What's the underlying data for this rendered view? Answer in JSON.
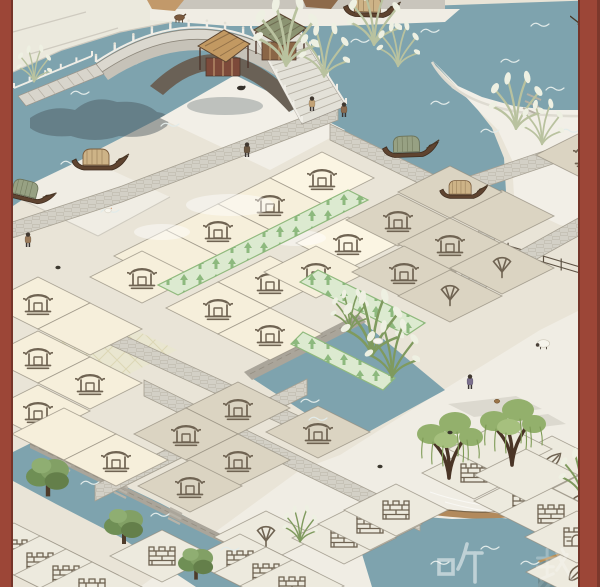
{
  "scene": {
    "title": "jiangnan-canal-town-map",
    "width": 600,
    "height": 587,
    "frame": {
      "color": "#9c4637",
      "left_width": 13,
      "right_width": 22
    }
  },
  "colors": {
    "frame": "#9c4637",
    "water": "#7ea3ae",
    "land": "#e9e4d7",
    "snow": "#f0ede4",
    "platform": "#f2efe7",
    "ledge": "#c9c5bc",
    "tile_cream": "#f6efdb",
    "tile_cream_light": "#fbf5e3",
    "tile_taupe": "#dbd4c2",
    "tile_pale": "#edeade",
    "tile_line": "#948d7f",
    "road": "#d3d0c6",
    "road_line": "#a59f91",
    "green_fill": "#dcead0",
    "green_border": "#8fb97c",
    "green_arrow": "#84b476",
    "icon_ink": "#6f6352",
    "bridge_stone": "#dbd8cf",
    "bridge_under": "#c6c2b8",
    "arch_dark": "#6a6156",
    "wall_stone": "#aaa59a",
    "pond_sand": "#b28a5c",
    "willow_green": "#93b06c",
    "reed_pale": "#b9c29f",
    "reed_dark": "#7f9a5e",
    "tree_green": "#6f8f55",
    "mat_teal": "#7e9ba1",
    "hull_brown": "#5f4430",
    "cabin_tan": "#cdb387",
    "cabin_green": "#97a183",
    "ink_shadow": "#46555c"
  },
  "watermarks": [
    {
      "char": "听",
      "glyph": "ting",
      "x": 436,
      "y": 538,
      "size": 48,
      "opacity": 0.5
    },
    {
      "char": "载",
      "glyph": "zai",
      "x": 534,
      "y": 544,
      "size": 42,
      "opacity": 0.25
    }
  ],
  "map": {
    "tile": {
      "width": 104,
      "height": 52
    },
    "fills": {
      "C": "tile_cream",
      "L": "tile_cream_light",
      "T": "tile_taupe",
      "P": "tile_pale"
    },
    "icon_names": {
      "house": "empty-plot-house-icon",
      "fan": "fan-plot-icon",
      "leaf": "leaf-plot-icon",
      "wall": "city-wall-plot-icon",
      "gate": "city-gate-plot-icon"
    },
    "tiles": [
      [
        322,
        178,
        "L",
        "house"
      ],
      [
        270,
        204,
        "C",
        "house"
      ],
      [
        218,
        230,
        "C",
        "house"
      ],
      [
        348,
        243,
        "L",
        "house"
      ],
      [
        166,
        256,
        "C",
        null
      ],
      [
        270,
        282,
        "C",
        "house"
      ],
      [
        218,
        308,
        "C",
        "house"
      ],
      [
        316,
        272,
        "C",
        "house"
      ],
      [
        270,
        334,
        "C",
        "house"
      ],
      [
        142,
        277,
        "C",
        "house"
      ],
      [
        38,
        303,
        "C",
        "house"
      ],
      [
        90,
        329,
        "C",
        null
      ],
      [
        38,
        357,
        "C",
        "house"
      ],
      [
        90,
        383,
        "C",
        "house"
      ],
      [
        38,
        411,
        "C",
        "house"
      ],
      [
        64,
        434,
        "C",
        null
      ],
      [
        116,
        460,
        "C",
        "house"
      ],
      [
        398,
        220,
        "T",
        "house"
      ],
      [
        450,
        244,
        "T",
        "house"
      ],
      [
        404,
        272,
        "T",
        "house"
      ],
      [
        502,
        268,
        "T",
        "fan"
      ],
      [
        450,
        296,
        "T",
        "fan"
      ],
      [
        502,
        216,
        "T",
        null
      ],
      [
        450,
        192,
        "T",
        null
      ],
      [
        588,
        155,
        "T",
        "house"
      ],
      [
        238,
        408,
        "T",
        "house"
      ],
      [
        186,
        434,
        "T",
        "house"
      ],
      [
        238,
        460,
        "T",
        "house"
      ],
      [
        318,
        432,
        "T",
        "house"
      ],
      [
        190,
        486,
        "T",
        "house"
      ],
      [
        552,
        462,
        "P",
        "leaf"
      ],
      [
        578,
        502,
        "P",
        "leaf"
      ],
      [
        578,
        572,
        "P",
        "leaf"
      ],
      [
        266,
        537,
        "P",
        "fan"
      ],
      [
        14,
        549,
        "P",
        "wall"
      ],
      [
        40,
        562,
        "P",
        "wall"
      ],
      [
        66,
        575,
        "P",
        "wall"
      ],
      [
        92,
        588,
        "P",
        "wall"
      ],
      [
        162,
        556,
        "P",
        "wall"
      ],
      [
        240,
        560,
        "P",
        "wall"
      ],
      [
        266,
        573,
        "P",
        "wall"
      ],
      [
        292,
        586,
        "P",
        "wall"
      ],
      [
        344,
        538,
        "P",
        "wall"
      ],
      [
        370,
        524,
        "P",
        "wall"
      ],
      [
        396,
        510,
        "P",
        "wall"
      ],
      [
        474,
        473,
        "P",
        "wall"
      ],
      [
        526,
        501,
        "P",
        "wall"
      ],
      [
        551,
        514,
        "P",
        "wall"
      ],
      [
        577,
        537,
        "P",
        "gate"
      ],
      [
        500,
        449,
        "P",
        null
      ],
      [
        526,
        475,
        "P",
        null
      ]
    ],
    "green_strips": [
      [
        [
          348,
          190
        ],
        [
          158,
          285
        ],
        [
          178,
          295
        ],
        [
          368,
          200
        ]
      ],
      [
        [
          318,
          270
        ],
        [
          425,
          323
        ],
        [
          407,
          335
        ],
        [
          300,
          282
        ]
      ],
      [
        [
          303,
          332
        ],
        [
          395,
          378
        ],
        [
          383,
          390
        ],
        [
          291,
          344
        ]
      ]
    ]
  },
  "objects": {
    "boats": [
      {
        "type": "a",
        "x": 70,
        "y": 146,
        "scale": 1,
        "rot": 0
      },
      {
        "type": "b",
        "x": 4,
        "y": 172,
        "scale": 0.95,
        "rot": 14
      },
      {
        "type": "a",
        "x": 342,
        "y": -8,
        "scale": 1,
        "rot": 2
      },
      {
        "type": "b",
        "x": 380,
        "y": 134,
        "scale": 1,
        "rot": -2
      },
      {
        "type": "a",
        "x": 438,
        "y": 178,
        "scale": 0.85,
        "rot": 0
      },
      {
        "type": "bow",
        "x": 570,
        "y": 6,
        "scale": 1,
        "rot": 0
      }
    ],
    "people": [
      {
        "x": 247,
        "y": 150,
        "color": "#6b5742"
      },
      {
        "x": 312,
        "y": 104,
        "color": "#c2a276"
      },
      {
        "x": 344,
        "y": 110,
        "color": "#8a6a4e"
      },
      {
        "x": 28,
        "y": 240,
        "color": "#9a7a5a"
      },
      {
        "x": 470,
        "y": 382,
        "color": "#7b6f8d"
      }
    ],
    "animals": [
      {
        "type": "sheep",
        "x": 543,
        "y": 344
      },
      {
        "type": "goose",
        "x": 378,
        "y": 340
      },
      {
        "type": "chicken",
        "x": 108,
        "y": 210
      },
      {
        "type": "chick",
        "x": 497,
        "y": 401
      },
      {
        "type": "dog",
        "x": 241,
        "y": 88
      },
      {
        "type": "donkey",
        "x": 180,
        "y": 18
      }
    ],
    "reeds": [
      [
        286,
        62,
        1.7,
        0
      ],
      [
        324,
        74,
        1.3,
        0
      ],
      [
        374,
        42,
        1.4,
        0
      ],
      [
        398,
        64,
        1.1,
        0
      ],
      [
        516,
        126,
        1.4,
        0
      ],
      [
        542,
        142,
        1.1,
        0
      ],
      [
        34,
        80,
        0.9,
        0
      ],
      [
        350,
        328,
        1.0,
        1
      ],
      [
        372,
        352,
        1.6,
        1
      ],
      [
        392,
        374,
        1.4,
        1
      ],
      [
        582,
        494,
        1.2,
        1
      ],
      [
        300,
        540,
        0.9,
        1
      ]
    ],
    "trees": [
      [
        48,
        492,
        1.1
      ],
      [
        124,
        540,
        1.0
      ],
      [
        196,
        576,
        0.9
      ]
    ],
    "willows": [
      [
        450,
        468
      ],
      [
        513,
        455
      ]
    ],
    "rocks": [
      [
        58,
        267
      ],
      [
        450,
        432
      ],
      [
        380,
        466
      ]
    ]
  },
  "bridge": {
    "name": "stone-arch-bridge",
    "stalls": [
      {
        "roof": "tan"
      },
      {
        "roof": "green"
      }
    ]
  }
}
